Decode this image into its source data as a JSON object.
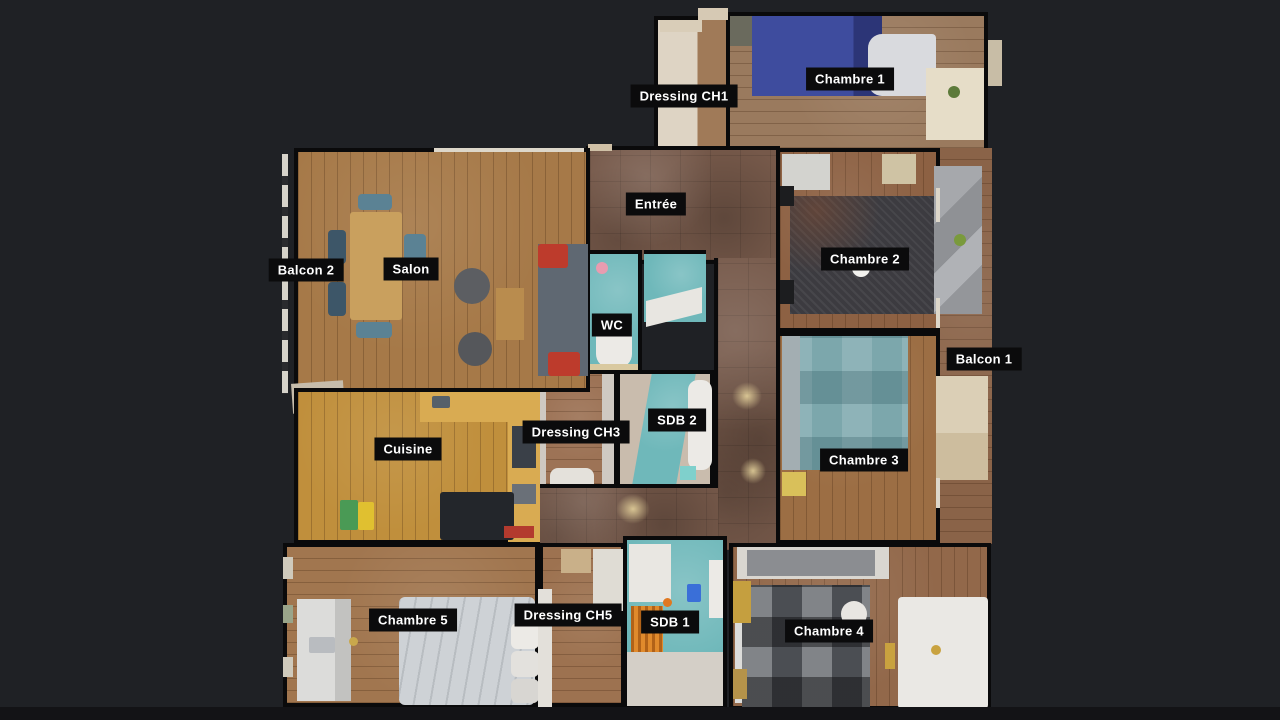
{
  "view": {
    "type": "3d-dollhouse-floorplan",
    "background_color": "#1f2125",
    "letterbox_color": "#131316",
    "label_bg_color": "#0b0b0c",
    "label_text_color": "#ffffff"
  },
  "floorplan": {
    "rooms": [
      {
        "id": "dressing-ch1",
        "label": "Dressing CH1"
      },
      {
        "id": "chambre-1",
        "label": "Chambre 1"
      },
      {
        "id": "entree",
        "label": "Entrée"
      },
      {
        "id": "balcon-2",
        "label": "Balcon 2"
      },
      {
        "id": "salon",
        "label": "Salon"
      },
      {
        "id": "wc",
        "label": "WC"
      },
      {
        "id": "chambre-2",
        "label": "Chambre 2"
      },
      {
        "id": "balcon-1",
        "label": "Balcon 1"
      },
      {
        "id": "dressing-ch3",
        "label": "Dressing CH3"
      },
      {
        "id": "sdb-2",
        "label": "SDB 2"
      },
      {
        "id": "chambre-3",
        "label": "Chambre 3"
      },
      {
        "id": "cuisine",
        "label": "Cuisine"
      },
      {
        "id": "chambre-5",
        "label": "Chambre 5"
      },
      {
        "id": "dressing-ch5",
        "label": "Dressing CH5"
      },
      {
        "id": "sdb-1",
        "label": "SDB 1"
      },
      {
        "id": "chambre-4",
        "label": "Chambre 4"
      }
    ],
    "palette": {
      "wood_warm": "#a67948",
      "wood_gold": "#c08f3c",
      "wood_brown": "#8d6143",
      "tile_brown": "#76594a",
      "bath_teal": "#6fb8ba",
      "bed_blue": "#3e4c9e",
      "bed_dark": "#3c3b40",
      "radiator_orange": "#e08a2c"
    }
  }
}
